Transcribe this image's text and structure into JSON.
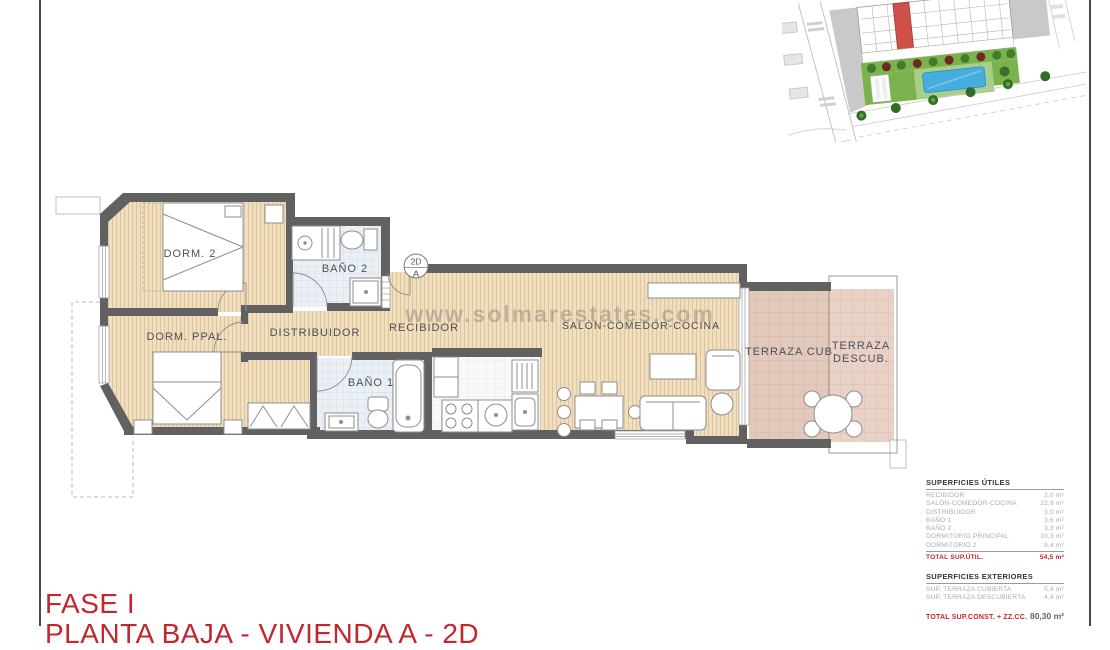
{
  "page": {
    "title_line1": "FASE I",
    "title_line2": "PLANTA BAJA - VIVIENDA A - 2D"
  },
  "watermark": "www.solmarestates.com",
  "floorplan": {
    "unit_badge": {
      "top": "2D",
      "bottom": "A"
    },
    "rooms": {
      "dorm2": "DORM. 2",
      "bano2": "BAÑO 2",
      "dorm_ppal": "DORM. PPAL.",
      "distribuidor": "DISTRIBUIDOR",
      "recibidor": "RECIBIDOR",
      "bano1": "BAÑO 1",
      "salon": "SALÓN-COMEDOR-COCINA",
      "terraza_cub": "TERRAZA CUB.",
      "terraza_descub_line1": "TERRAZA",
      "terraza_descub_line2": "DESCUB."
    }
  },
  "areas_table": {
    "utiles": {
      "heading": "SUPERFICIES ÚTILES",
      "rows": [
        {
          "label": "RECIBIDOR",
          "value": "2,0 m²"
        },
        {
          "label": "SALÓN-COMEDOR-COCINA",
          "value": "22,9 m²"
        },
        {
          "label": "DISTRIBUIDOR",
          "value": "3,0 m²"
        },
        {
          "label": "BAÑO 1",
          "value": "3,6 m²"
        },
        {
          "label": "BAÑO 2",
          "value": "3,3 m²"
        },
        {
          "label": "DORMITORIO PRINCIPAL",
          "value": "10,3 m²"
        },
        {
          "label": "DORMITORIO 2",
          "value": "9,4 m²"
        }
      ],
      "total_label": "TOTAL SUP.ÚTIL.",
      "total_value": "54,5 m²"
    },
    "exteriores": {
      "heading": "SUPERFICIES EXTERIORES",
      "rows": [
        {
          "label": "SUP. TERRAZA CUBIERTA",
          "value": "5,4 m²"
        },
        {
          "label": "SUP. TERRAZA DESCUBIERTA",
          "value": "4,4 m²"
        }
      ]
    },
    "total_const": {
      "label": "TOTAL SUP.CONST. + ZZ.CC.",
      "value": "80,30 m²"
    }
  },
  "colors": {
    "accent_red": "#c1272d",
    "wall_gray": "#616161",
    "wood_floor": "#f1debe",
    "bath_tile": "#eaf0f5",
    "terrace_tile": "#e9d1c6",
    "pool_blue": "#45aede",
    "garden_green": "#7cb24e",
    "highlight_unit_red": "#cf5049"
  }
}
